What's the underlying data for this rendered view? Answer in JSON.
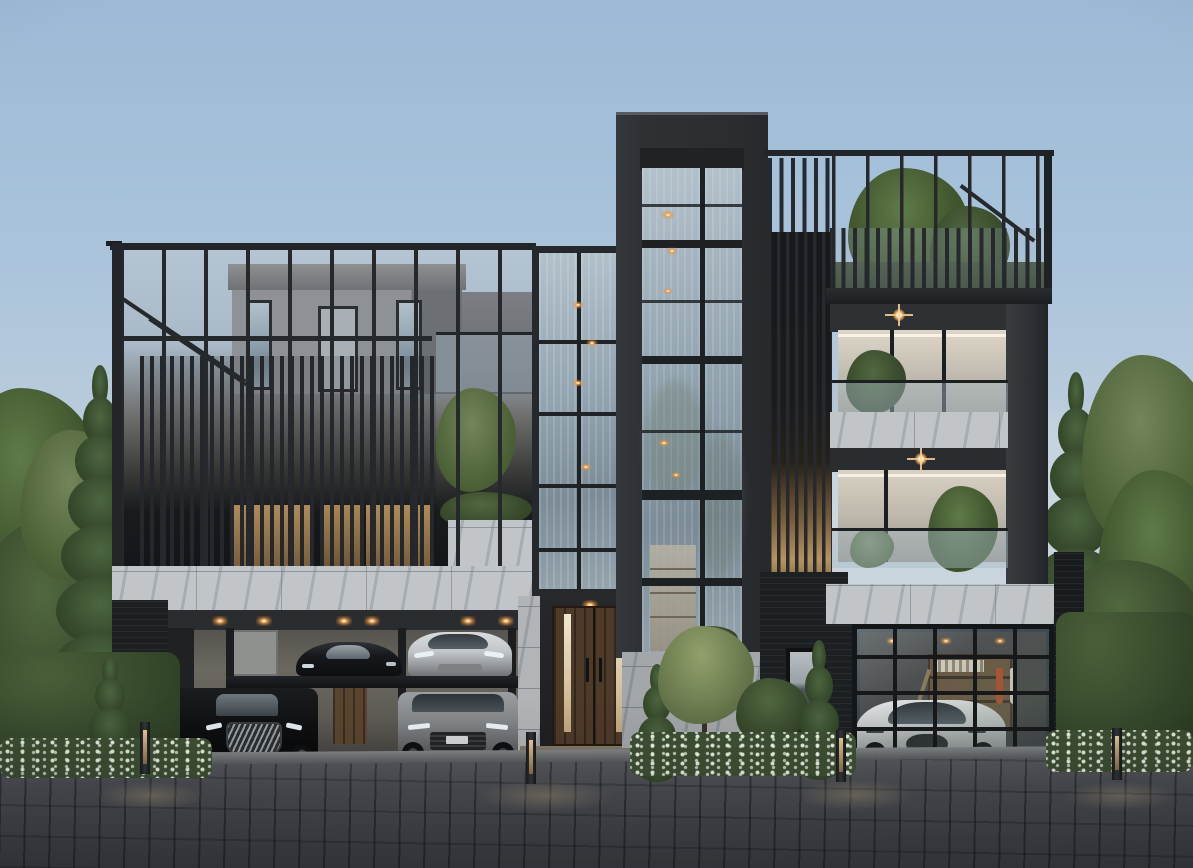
{
  "scene_type": "3D architectural exterior rendering of a modern luxury residence at dusk",
  "time_of_day": "dusk",
  "palette": {
    "sky_top": "#9cbad6",
    "sky_horizon": "#d9dde0",
    "charcoal_frame": "#2b2e31",
    "slat_dark": "#24282c",
    "marble_stone": "#c1c5c8",
    "glass_blue": "#93a5b1",
    "warm_light": "#e8a85f",
    "timber_door": "#4e3a29",
    "foliage": "#42572f",
    "pavement": "#4c4e53"
  },
  "labels": {
    "sky": "Dusk sky",
    "left_wing": "Louvered screen wing with roof terrace",
    "penthouse": "Rooftop penthouse volume",
    "stair_tower": "Glazed stair tower",
    "central_tower": "Full-height glazed central tower",
    "louver_column": "Backlit louver screen column",
    "right_wing": "Balcony wing with glass balustrades",
    "roof_terrace": "Roof terrace with planting and slatted railing",
    "upper_balcony": "Upper balcony with plants",
    "lower_balcony": "Lower balcony with plants",
    "carport": "Double-deck car-stacker carport",
    "garage": "Glazed-door garage with workshop shelving",
    "entrance": "Timber double entrance door with lit glass strips",
    "entry_steps": "Entry steps",
    "stone_band": "Marble spandrel band",
    "garden": "Front garden bed with flowering shrubs",
    "left_trees": "Trees at left boundary",
    "right_trees": "Trees at right boundary",
    "hedge": "Clipped boundary hedge",
    "driveway": "Grey cobblestone driveway",
    "bollard": "Warm LED bollard light",
    "downlights": "Recessed warm downlights"
  },
  "cars": {
    "stacker_upper_left": "Black supercar on upper lift deck",
    "stacker_upper_right": "Silver sedan on upper lift deck",
    "stacker_lower_left": "Black luxury minivan with chrome grille",
    "stacker_lower_right": "Grey luxury SUV",
    "garage_car": "White hypercar behind glazed garage door"
  },
  "lighting": [
    "warm recessed downlights in carport soffit",
    "star-glow balcony downlights",
    "backlit louver screens",
    "entry door light strips",
    "bollard path lights"
  ]
}
